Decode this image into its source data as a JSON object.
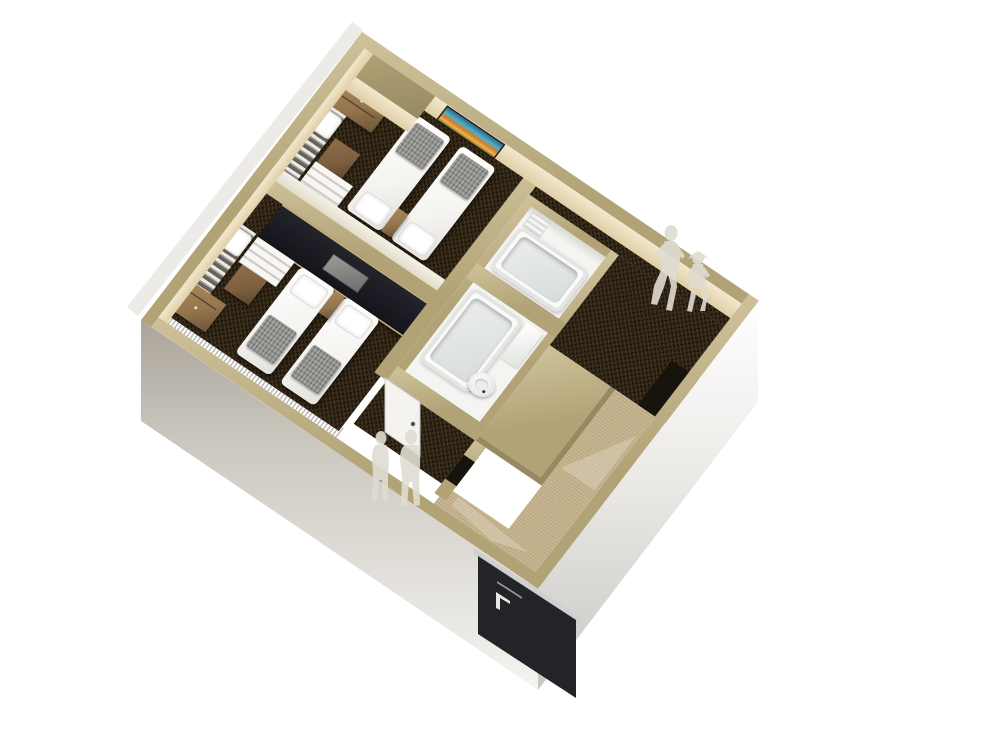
{
  "scene": {
    "title": "3D isometric cutaway floor plan render of a twin hotel room suite",
    "style": "architectural-render",
    "background": "#ffffff"
  },
  "palette": {
    "wall_cap": "#b2a377",
    "wall_cap_light": "#cfc29a",
    "wall_face": "#f3e8cc",
    "wall_face_dark": "#dfcfa8",
    "carpet_dark": "#281f13",
    "carpet_entry": "#c2af88",
    "bathroom_white": "#f4f4f2",
    "bed_white": "#f4f3f0",
    "blanket_gray": "#8d8d8a",
    "wood": "#96764e",
    "wood_dark": "#6e563a",
    "cube_brown": "#7c5f3f",
    "panel_black": "#14141b",
    "trim_gold": "#c9b37a",
    "door_black": "#232328",
    "figure": "#dfdcd2",
    "glass": "#8a857c",
    "outer_band": "#d9d6cf"
  },
  "art": {
    "frame": "#1d1d1d",
    "stripes": [
      "#2a6b8f",
      "#4db0c4",
      "#d97a2a",
      "#e8b84a"
    ]
  },
  "rooms": [
    {
      "id": "bedroom-upper",
      "floor": "dark-carpet",
      "furniture": [
        "wall-art",
        "dresser",
        "loft-bunk-with-rail",
        "bunk-pillow",
        "stool-cube",
        "stairs",
        "twin-bed",
        "twin-bed",
        "nightstand"
      ]
    },
    {
      "id": "bedroom-lower",
      "floor": "dark-carpet",
      "furniture": [
        "black-headboard-console",
        "stairs",
        "loft-bunk-with-rail",
        "bunk-pillow",
        "stool-cube",
        "dresser",
        "twin-bed",
        "twin-bed",
        "nightstand",
        "glass-cut-wall"
      ]
    },
    {
      "id": "bathroom-upper",
      "floor": "white",
      "furniture": [
        "bathtub",
        "towel-rack"
      ]
    },
    {
      "id": "bathroom-lower",
      "floor": "white",
      "furniture": [
        "bathtub",
        "counter",
        "toilet",
        "bathroom-door"
      ]
    },
    {
      "id": "corridor",
      "floor": "dark-carpet",
      "furniture": [
        "closet-niche"
      ]
    },
    {
      "id": "vestibule",
      "floor": "dark-carpet",
      "furniture": [
        "wall-niche"
      ]
    },
    {
      "id": "entry",
      "floor": "beige-carpet",
      "furniture": [
        "entrance-door"
      ]
    }
  ],
  "figures": [
    {
      "id": "walking-adult",
      "location": "corridor"
    },
    {
      "id": "walking-child",
      "location": "corridor"
    },
    {
      "id": "standing-adult-1",
      "location": "bedroom-lower"
    },
    {
      "id": "standing-adult-2",
      "location": "bedroom-lower"
    }
  ]
}
